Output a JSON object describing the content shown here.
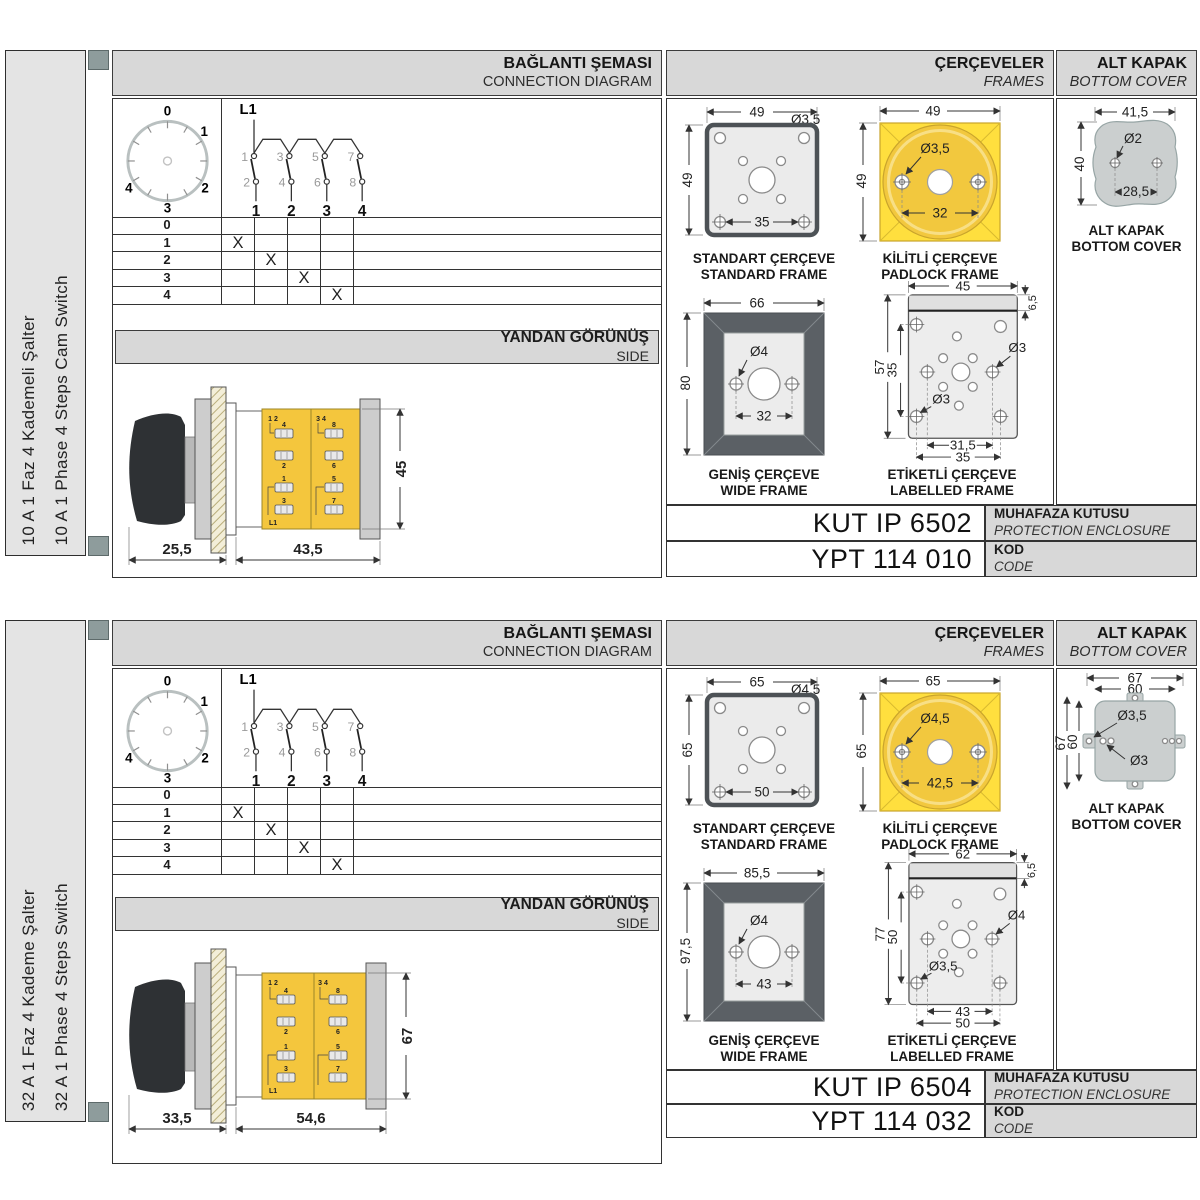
{
  "colors": {
    "body_yellow": "#f4c63d",
    "padlock_yellow": "#ffdf3e",
    "padlock_circle": "#f2c83e",
    "frame_dark": "#5b6065",
    "band_gray": "#d8d8d8",
    "sidebar_gray": "#e4e4e4",
    "cover_gray": "#cbcfcf",
    "strip_square": "#8e9c9c"
  },
  "sections": [
    {
      "sidebar": {
        "line1": "10 A 1 Faz 4 Kademeli Şalter",
        "line2": "10 A 1 Phase 4 Steps Cam Switch"
      },
      "headers": {
        "connection_tr": "BAĞLANTI ŞEMASI",
        "connection_en": "CONNECTION DIAGRAM",
        "frames_tr": "ÇERÇEVELER",
        "frames_en": "FRAMES",
        "cover_tr": "ALT KAPAK",
        "cover_en": "BOTTOM COVER",
        "side_tr": "YANDAN GÖRÜNÜŞ",
        "side_en": "SIDE"
      },
      "dial": {
        "pos0": "0",
        "pos1": "1",
        "pos2": "2",
        "pos3": "3",
        "pos4": "4"
      },
      "schematic": {
        "source": "L1",
        "contacts_top": [
          "1",
          "3",
          "5",
          "7"
        ],
        "contacts_bottom": [
          "2",
          "4",
          "6",
          "8"
        ],
        "outputs": [
          "1",
          "2",
          "3",
          "4"
        ]
      },
      "switch_table": {
        "rows": [
          {
            "label": "0",
            "marks": [
              "",
              "",
              "",
              ""
            ]
          },
          {
            "label": "1",
            "marks": [
              "X",
              "",
              "",
              ""
            ]
          },
          {
            "label": "2",
            "marks": [
              "",
              "X",
              "",
              ""
            ]
          },
          {
            "label": "3",
            "marks": [
              "",
              "",
              "X",
              ""
            ]
          },
          {
            "label": "4",
            "marks": [
              "",
              "",
              "",
              "X"
            ]
          }
        ]
      },
      "side_view": {
        "dim_width_handle": "25,5",
        "dim_width_body": "43,5",
        "dim_height": "45",
        "corner_left": "1 2",
        "corner_right": "3 4",
        "source": "L1",
        "terminals_left": [
          "4",
          "2",
          "1",
          "3"
        ],
        "terminals_right": [
          "8",
          "6",
          "5",
          "7"
        ]
      },
      "frames": {
        "standard": {
          "title_tr": "STANDART ÇERÇEVE",
          "title_en": "STANDARD FRAME",
          "dim_width": "49",
          "dim_height": "49",
          "dim_hole": "Ø3,5",
          "dim_inner": "35"
        },
        "padlock": {
          "title_tr": "KİLİTLİ ÇERÇEVE",
          "title_en": "PADLOCK FRAME",
          "dim_width": "49",
          "dim_height": "49",
          "dim_hole": "Ø3,5",
          "dim_inner": "32"
        },
        "wide": {
          "title_tr": "GENİŞ ÇERÇEVE",
          "title_en": "WIDE FRAME",
          "dim_width": "66",
          "dim_height": "80",
          "dim_hole": "Ø4",
          "dim_inner": "32"
        },
        "labelled": {
          "title_tr": "ETİKETLİ ÇERÇEVE",
          "title_en": "LABELLED FRAME",
          "dim_width": "45",
          "dim_strip": "6,5",
          "dim_height": "57",
          "dim_inner_v": "35",
          "dim_hole_right": "Ø3",
          "dim_hole_left": "Ø3",
          "dim_bottom_inner": "31,5",
          "dim_bottom_outer": "35"
        }
      },
      "cover": {
        "caption_tr": "ALT KAPAK",
        "caption_en": "BOTTOM COVER",
        "dim_width": "41,5",
        "dim_height": "40",
        "dim_hole": "Ø2",
        "dim_inner": "28,5"
      },
      "codes": {
        "enclosure_value": "KUT IP 6502",
        "enclosure_label_tr": "MUHAFAZA KUTUSU",
        "enclosure_label_en": "PROTECTION ENCLOSURE",
        "code_value": "YPT 114 010",
        "code_label_tr": "KOD",
        "code_label_en": "CODE"
      }
    },
    {
      "sidebar": {
        "line1": "32 A 1 Faz 4 Kademe Şalter",
        "line2": "32 A 1 Phase 4 Steps Switch"
      },
      "headers": {
        "connection_tr": "BAĞLANTI ŞEMASI",
        "connection_en": "CONNECTION DIAGRAM",
        "frames_tr": "ÇERÇEVELER",
        "frames_en": "FRAMES",
        "cover_tr": "ALT KAPAK",
        "cover_en": "BOTTOM COVER",
        "side_tr": "YANDAN GÖRÜNÜŞ",
        "side_en": "SIDE"
      },
      "dial": {
        "pos0": "0",
        "pos1": "1",
        "pos2": "2",
        "pos3": "3",
        "pos4": "4"
      },
      "schematic": {
        "source": "L1",
        "contacts_top": [
          "1",
          "3",
          "5",
          "7"
        ],
        "contacts_bottom": [
          "2",
          "4",
          "6",
          "8"
        ],
        "outputs": [
          "1",
          "2",
          "3",
          "4"
        ]
      },
      "switch_table": {
        "rows": [
          {
            "label": "0",
            "marks": [
              "",
              "",
              "",
              ""
            ]
          },
          {
            "label": "1",
            "marks": [
              "X",
              "",
              "",
              ""
            ]
          },
          {
            "label": "2",
            "marks": [
              "",
              "X",
              "",
              ""
            ]
          },
          {
            "label": "3",
            "marks": [
              "",
              "",
              "X",
              ""
            ]
          },
          {
            "label": "4",
            "marks": [
              "",
              "",
              "",
              "X"
            ]
          }
        ]
      },
      "side_view": {
        "dim_width_handle": "33,5",
        "dim_width_body": "54,6",
        "dim_height": "67",
        "corner_left": "1 2",
        "corner_right": "3 4",
        "source": "L1",
        "terminals_left": [
          "4",
          "2",
          "1",
          "3"
        ],
        "terminals_right": [
          "8",
          "6",
          "5",
          "7"
        ]
      },
      "frames": {
        "standard": {
          "title_tr": "STANDART ÇERÇEVE",
          "title_en": "STANDARD FRAME",
          "dim_width": "65",
          "dim_height": "65",
          "dim_hole": "Ø4,5",
          "dim_inner": "50"
        },
        "padlock": {
          "title_tr": "KİLİTLİ ÇERÇEVE",
          "title_en": "PADLOCK FRAME",
          "dim_width": "65",
          "dim_height": "65",
          "dim_hole": "Ø4,5",
          "dim_inner": "42,5"
        },
        "wide": {
          "title_tr": "GENİŞ ÇERÇEVE",
          "title_en": "WIDE FRAME",
          "dim_width": "85,5",
          "dim_height": "97,5",
          "dim_hole": "Ø4",
          "dim_inner": "43"
        },
        "labelled": {
          "title_tr": "ETİKETLİ ÇERÇEVE",
          "title_en": "LABELLED FRAME",
          "dim_width": "62",
          "dim_strip": "6,5",
          "dim_height": "77",
          "dim_inner_v": "50",
          "dim_hole_right": "Ø4",
          "dim_hole_left": "Ø3,5",
          "dim_bottom_inner": "43",
          "dim_bottom_outer": "50"
        }
      },
      "cover": {
        "caption_tr": "ALT KAPAK",
        "caption_en": "BOTTOM COVER",
        "dim_width_outer": "67",
        "dim_width_inner": "60",
        "dim_height_outer": "67",
        "dim_height_inner": "60",
        "dim_hole_tab": "Ø3,5",
        "dim_hole": "Ø3"
      },
      "codes": {
        "enclosure_value": "KUT IP 6504",
        "enclosure_label_tr": "MUHAFAZA KUTUSU",
        "enclosure_label_en": "PROTECTION ENCLOSURE",
        "code_value": "YPT 114 032",
        "code_label_tr": "KOD",
        "code_label_en": "CODE"
      }
    }
  ]
}
